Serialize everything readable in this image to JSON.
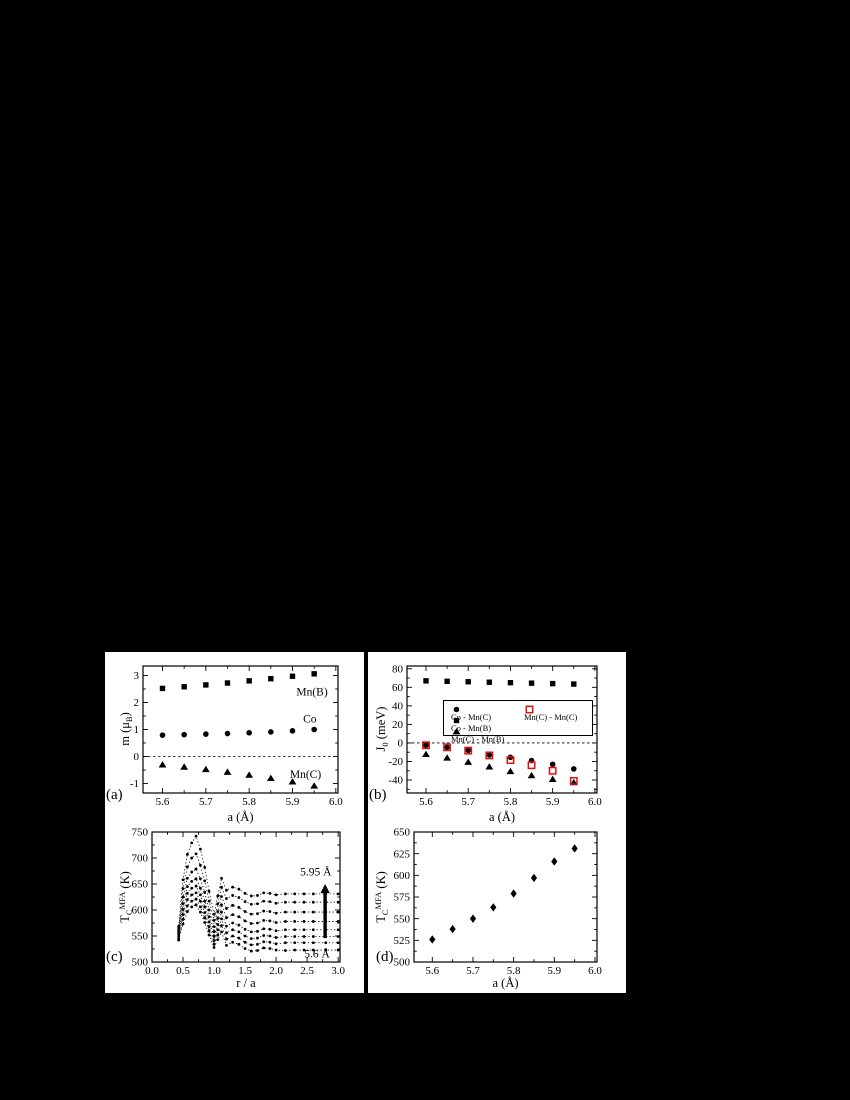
{
  "figure": {
    "background": "#000000",
    "panel_background": "#ffffff",
    "ink": "#000000",
    "accent_red": "#e01010"
  },
  "chart_data": [
    {
      "id": "a",
      "type": "scatter",
      "panel_label": "(a)",
      "xlabel": "a (Å)",
      "ylabel_parts": [
        {
          "t": "m (μ"
        },
        {
          "t": "B"
        },
        {
          "t": ")"
        }
      ],
      "x_axis": {
        "min": 5.555,
        "max": 6.005,
        "ticks": [
          5.6,
          5.7,
          5.8,
          5.9,
          6.0
        ],
        "tick_labels": [
          "5.6",
          "5.7",
          "5.8",
          "5.9",
          "6.0"
        ],
        "minor_step": 0.05
      },
      "y_axis": {
        "min": -1.35,
        "max": 3.35,
        "ticks": [
          -1,
          0,
          1,
          2,
          3
        ],
        "tick_labels": [
          "-1",
          "0",
          "1",
          "2",
          "3"
        ],
        "minor_step": 0.5
      },
      "zero_line": true,
      "x": [
        5.6,
        5.65,
        5.7,
        5.75,
        5.8,
        5.85,
        5.9,
        5.95
      ],
      "series": [
        {
          "name": "Mn(B)",
          "marker": "square",
          "color": "#000000",
          "values": [
            2.52,
            2.58,
            2.65,
            2.72,
            2.8,
            2.88,
            2.97,
            3.06
          ]
        },
        {
          "name": "Co",
          "marker": "circle",
          "color": "#000000",
          "values": [
            0.79,
            0.81,
            0.83,
            0.85,
            0.88,
            0.91,
            0.95,
            1.0
          ]
        },
        {
          "name": "Mn(C)",
          "marker": "triangle",
          "color": "#000000",
          "values": [
            -0.3,
            -0.38,
            -0.47,
            -0.57,
            -0.68,
            -0.8,
            -0.93,
            -1.08
          ]
        }
      ],
      "annotations": [
        {
          "text": "Mn(B)",
          "x": 5.945,
          "y": 2.4
        },
        {
          "text": "Co",
          "x": 5.94,
          "y": 1.4
        },
        {
          "text": "Mn(C)",
          "x": 5.93,
          "y": -0.64
        }
      ]
    },
    {
      "id": "b",
      "type": "scatter",
      "panel_label": "(b)",
      "xlabel": "a (Å)",
      "ylabel_parts": [
        {
          "t": "J"
        },
        {
          "t": "0"
        },
        {
          "t": " (meV)"
        }
      ],
      "x_axis": {
        "min": 5.555,
        "max": 6.005,
        "ticks": [
          5.6,
          5.7,
          5.8,
          5.9,
          6.0
        ],
        "tick_labels": [
          "5.6",
          "5.7",
          "5.8",
          "5.9",
          "6.0"
        ],
        "minor_step": 0.05
      },
      "y_axis": {
        "min": -54,
        "max": 83,
        "ticks": [
          -40,
          -20,
          0,
          20,
          40,
          60,
          80
        ],
        "tick_labels": [
          "-40",
          "-20",
          "0",
          "20",
          "40",
          "60",
          "80"
        ],
        "minor_step": 10
      },
      "zero_line": true,
      "x": [
        5.6,
        5.65,
        5.7,
        5.75,
        5.8,
        5.85,
        5.9,
        5.95
      ],
      "series": [
        {
          "name": "Co - Mn(B)",
          "marker": "square",
          "color": "#000000",
          "values": [
            67,
            66.5,
            66,
            65.5,
            65,
            64.5,
            64,
            63.5
          ]
        },
        {
          "name": "Mn(C) - Mn(B)",
          "marker": "triangle",
          "color": "#000000",
          "values": [
            -12,
            -16,
            -20.5,
            -25.5,
            -30.5,
            -35,
            -39,
            -42.5
          ]
        },
        {
          "name": "Co - Mn(C)",
          "marker": "circle",
          "color": "#000000",
          "values": [
            -2.5,
            -4.7,
            -8,
            -13,
            -15.5,
            -19,
            -23,
            -28
          ]
        },
        {
          "name": "Mn(C) - Mn(C)",
          "marker": "square-open",
          "color": "#e01010",
          "values": [
            -2.5,
            -4.7,
            -8.3,
            -13.5,
            -18.5,
            -24,
            -30,
            -41
          ]
        }
      ],
      "legend": {
        "items": [
          {
            "marker": "circle",
            "color": "#000000",
            "label": "Co - Mn(C)"
          },
          {
            "marker": "square",
            "color": "#000000",
            "label": "Co - Mn(B)"
          },
          {
            "marker": "triangle",
            "color": "#000000",
            "label": "Mn(C) - Mn(B)"
          },
          {
            "marker": "square-open",
            "color": "#e01010",
            "label": "Mn(C) - Mn(C)"
          }
        ]
      },
      "annotations": []
    },
    {
      "id": "c",
      "type": "line",
      "panel_label": "(c)",
      "xlabel": "r / a",
      "ylabel_parts": [
        {
          "t": "T"
        },
        {
          "t": "C"
        },
        {
          "t": "MFA"
        },
        {
          "t": " (K)"
        }
      ],
      "x_axis": {
        "min": 0.0,
        "max": 3.03,
        "ticks": [
          0.0,
          0.5,
          1.0,
          1.5,
          2.0,
          2.5,
          3.0
        ],
        "tick_labels": [
          "0.0",
          "0.5",
          "1.0",
          "1.5",
          "2.0",
          "2.5",
          "3.0"
        ],
        "minor_step": 0.25
      },
      "y_axis": {
        "min": 500,
        "max": 750,
        "ticks": [
          500,
          550,
          600,
          650,
          700,
          750
        ],
        "tick_labels": [
          "500",
          "550",
          "600",
          "650",
          "700",
          "750"
        ],
        "minor_step": 25
      },
      "zero_line": false,
      "x": [
        0.43,
        0.5,
        0.57,
        0.64,
        0.71,
        0.78,
        0.85,
        0.92,
        1.0,
        1.06,
        1.12,
        1.2,
        1.3,
        1.4,
        1.5,
        1.6,
        1.7,
        1.8,
        1.9,
        2.0,
        2.15,
        2.3,
        2.45,
        2.6,
        2.8,
        3.0
      ],
      "series": [
        {
          "name": "5.60 Å",
          "marker": "dot",
          "color": "#000000",
          "values": [
            542,
            573,
            597,
            606,
            610,
            596,
            576,
            552,
            528,
            543,
            558,
            532,
            538,
            534,
            526,
            521,
            522,
            527,
            526,
            523,
            522,
            523,
            523,
            523,
            523,
            523
          ]
        },
        {
          "name": "5.65 Å",
          "marker": "dot",
          "color": "#000000",
          "values": [
            545,
            582,
            608,
            617,
            621,
            606,
            585,
            560,
            534,
            552,
            570,
            544,
            550,
            546,
            538,
            533,
            534,
            539,
            538,
            535,
            537,
            537,
            537,
            537,
            537,
            537
          ]
        },
        {
          "name": "5.70 Å",
          "marker": "dot",
          "color": "#000000",
          "values": [
            549,
            591,
            620,
            629,
            633,
            617,
            595,
            568,
            541,
            562,
            583,
            556,
            562,
            558,
            550,
            545,
            546,
            551,
            550,
            547,
            549,
            549,
            549,
            549,
            549,
            549
          ]
        },
        {
          "name": "5.75 Å",
          "marker": "dot",
          "color": "#000000",
          "values": [
            553,
            601,
            632,
            642,
            646,
            629,
            606,
            577,
            549,
            572,
            596,
            569,
            575,
            571,
            563,
            558,
            559,
            564,
            563,
            560,
            562,
            562,
            562,
            562,
            562,
            562
          ]
        },
        {
          "name": "5.80 Å",
          "marker": "dot",
          "color": "#000000",
          "values": [
            557,
            612,
            645,
            655,
            660,
            642,
            617,
            587,
            558,
            584,
            610,
            585,
            591,
            587,
            579,
            574,
            575,
            580,
            579,
            576,
            578,
            578,
            578,
            578,
            578,
            578
          ]
        },
        {
          "name": "5.85 Å",
          "marker": "dot",
          "color": "#000000",
          "values": [
            561,
            625,
            661,
            673,
            679,
            660,
            634,
            600,
            568,
            597,
            626,
            603,
            609,
            605,
            597,
            592,
            593,
            598,
            597,
            594,
            596,
            596,
            596,
            596,
            596,
            596
          ]
        },
        {
          "name": "5.90 Å",
          "marker": "dot",
          "color": "#000000",
          "values": [
            565,
            641,
            683,
            700,
            708,
            686,
            656,
            617,
            580,
            612,
            644,
            622,
            628,
            624,
            616,
            611,
            612,
            617,
            616,
            613,
            615,
            615,
            615,
            615,
            615,
            615
          ]
        },
        {
          "name": "5.95 Å",
          "marker": "dot",
          "color": "#000000",
          "values": [
            569,
            658,
            707,
            729,
            742,
            717,
            682,
            636,
            592,
            627,
            661,
            638,
            644,
            640,
            632,
            627,
            628,
            633,
            632,
            629,
            631,
            631,
            631,
            631,
            631,
            631
          ]
        }
      ],
      "arrow": {
        "x": 2.79,
        "y_from": 546,
        "y_to": 650
      },
      "annotations": [
        {
          "text": "5.95 Å",
          "x": 2.64,
          "y": 674
        },
        {
          "text": "5.6 Å",
          "x": 2.66,
          "y": 516
        }
      ]
    },
    {
      "id": "d",
      "type": "scatter",
      "panel_label": "(d)",
      "xlabel": "a (Å)",
      "ylabel_parts": [
        {
          "t": "T"
        },
        {
          "t": "C"
        },
        {
          "t": "MFA"
        },
        {
          "t": " (K)"
        }
      ],
      "x_axis": {
        "min": 5.555,
        "max": 6.005,
        "ticks": [
          5.6,
          5.7,
          5.8,
          5.9,
          6.0
        ],
        "tick_labels": [
          "5.6",
          "5.7",
          "5.8",
          "5.9",
          "6.0"
        ],
        "minor_step": 0.05
      },
      "y_axis": {
        "min": 500,
        "max": 650,
        "ticks": [
          500,
          525,
          550,
          575,
          600,
          625,
          650
        ],
        "tick_labels": [
          "500",
          "525",
          "550",
          "575",
          "600",
          "625",
          "650"
        ],
        "minor_step": 12.5
      },
      "zero_line": false,
      "x": [
        5.6,
        5.65,
        5.7,
        5.75,
        5.8,
        5.85,
        5.9,
        5.95
      ],
      "series": [
        {
          "name": "TC-MFA",
          "marker": "diamond",
          "color": "#000000",
          "values": [
            526,
            538,
            550,
            563,
            579,
            597,
            616,
            631
          ]
        }
      ],
      "annotations": []
    }
  ]
}
